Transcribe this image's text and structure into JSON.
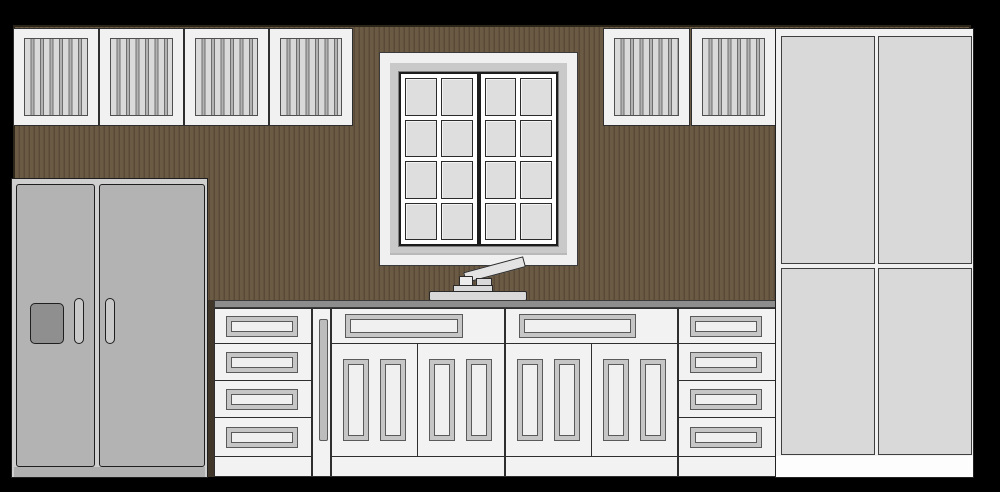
{
  "scene": {
    "name": "kitchen-elevation-drawing",
    "canvas": {
      "width": 1000,
      "height": 492,
      "background": "#000000"
    },
    "wall": {
      "x": 13,
      "y": 25,
      "width": 958,
      "height": 283,
      "color": "#6b5b45",
      "stripe": "#584a36",
      "stripe_period": 5,
      "border": "#2b2418"
    },
    "fridge_gap": {
      "x": 208,
      "y": 300,
      "width": 6,
      "height": 177,
      "color": "#40362a"
    },
    "upper_cabinets": {
      "y": 28,
      "height": 98,
      "style": {
        "fill": "#f1f1f1",
        "border": "#2e2e2e",
        "panel_fill": "#d9d9d9",
        "panel_border": "#4f4f4f",
        "slat_dark": "#6e6e6e",
        "slat_light": "#b2b2b2",
        "panel_inset_x": 10,
        "panel_inset_y": 9
      },
      "items": [
        {
          "x": 13,
          "width": 86
        },
        {
          "x": 99,
          "width": 85
        },
        {
          "x": 184,
          "width": 85
        },
        {
          "x": 269,
          "width": 84
        },
        {
          "x": 603,
          "width": 87
        },
        {
          "x": 691,
          "width": 85
        }
      ]
    },
    "window": {
      "x": 379,
      "y": 52,
      "width": 199,
      "height": 214,
      "frame": "#f0f0f0",
      "frame_border": "#3a3a3a",
      "mat": "#c9c9c9",
      "mat_inset": 10,
      "inner_inset": 18,
      "inner_fill": "#f5f5f5",
      "sash_bg": "#ffffff",
      "sash_border": "#1c1c1c",
      "pane": "#dedede",
      "pane_border": "#2a2a2a",
      "casements": 2,
      "pane_columns": 2,
      "pane_rows": 4
    },
    "faucet": {
      "border": "#2a2a2a",
      "spout": {
        "x": 466,
        "y": 272,
        "width": 62,
        "height": 11,
        "angle": -15,
        "color": "#e3e3e3"
      },
      "knob": {
        "x": 459,
        "y": 276,
        "width": 14,
        "height": 12,
        "color": "#ececec"
      },
      "connector": {
        "x": 476,
        "y": 278,
        "width": 16,
        "height": 13,
        "color": "#d9d9d9"
      },
      "mid_plate": {
        "x": 453,
        "y": 285,
        "width": 40,
        "height": 8,
        "color": "#d9d9d9"
      },
      "base_plate": {
        "x": 429,
        "y": 291,
        "width": 98,
        "height": 10,
        "color": "#d9d9d9"
      }
    },
    "countertop": {
      "x": 214,
      "y": 300,
      "width": 562,
      "height": 8,
      "color": "#8d8d8d",
      "border": "#3a3a3a"
    },
    "base_run": {
      "y": 308,
      "height": 169,
      "toe_line_offset": 148,
      "fill": "#f2f2f2",
      "border": "#2e2e2e",
      "recess": {
        "ring": "#c6c6c6",
        "center": "#f0f0f0",
        "border": "#5a5a5a"
      },
      "sink_style": {
        "top_drawer_height": 35,
        "door_pill": {
          "width": 26,
          "height": 82,
          "top": 15,
          "offsets": [
            11,
            48
          ]
        }
      },
      "cabinets": [
        {
          "type": "drawer-unit",
          "x": 214,
          "width": 98,
          "drawer_heights": [
            35,
            37,
            37,
            39
          ]
        },
        {
          "type": "filler",
          "x": 312,
          "width": 19,
          "pill": {
            "x": 6,
            "y": 10,
            "width": 9,
            "height": 122,
            "color": "#bdbdbd"
          }
        },
        {
          "type": "sink-cabinet",
          "x": 331,
          "width": 174
        },
        {
          "type": "sink-cabinet",
          "x": 505,
          "width": 173
        },
        {
          "type": "drawer-unit",
          "x": 678,
          "width": 98,
          "drawer_heights": [
            35,
            37,
            37,
            39
          ]
        }
      ]
    },
    "tall_cabinet": {
      "x": 775,
      "y": 28,
      "width": 199,
      "height": 450,
      "fill": "#f1f1f1",
      "border": "#222222",
      "door_fill": "#d9d9d9",
      "door_border": "#3f3f3f",
      "door_columns": [
        {
          "x": 5,
          "width": 94
        },
        {
          "x": 102,
          "width": 94
        }
      ],
      "door_rows": [
        {
          "y": 7,
          "height": 228
        },
        {
          "y": 239,
          "height": 187
        }
      ],
      "plinth": {
        "y": 427,
        "height": 21,
        "color": "#fdfdfd"
      }
    },
    "refrigerator": {
      "x": 11,
      "y": 178,
      "width": 197,
      "height": 300,
      "body": "#cfcfcf",
      "border": "#1f1f1f",
      "door_fill": "#b3b3b3",
      "door_y": 5,
      "door_height": 283,
      "doors": [
        {
          "x": 4,
          "width": 79
        },
        {
          "x": 87,
          "width": 106
        }
      ],
      "base": {
        "y": 288,
        "height": 10,
        "color": "#b0b0b0"
      },
      "dispenser": {
        "x": 18,
        "y": 124,
        "width": 34,
        "height": 41,
        "color": "#8f8f8f"
      },
      "handles": {
        "xs": [
          62,
          93
        ],
        "y": 119,
        "width": 10,
        "height": 46,
        "color": "#c9c9c9"
      }
    }
  }
}
